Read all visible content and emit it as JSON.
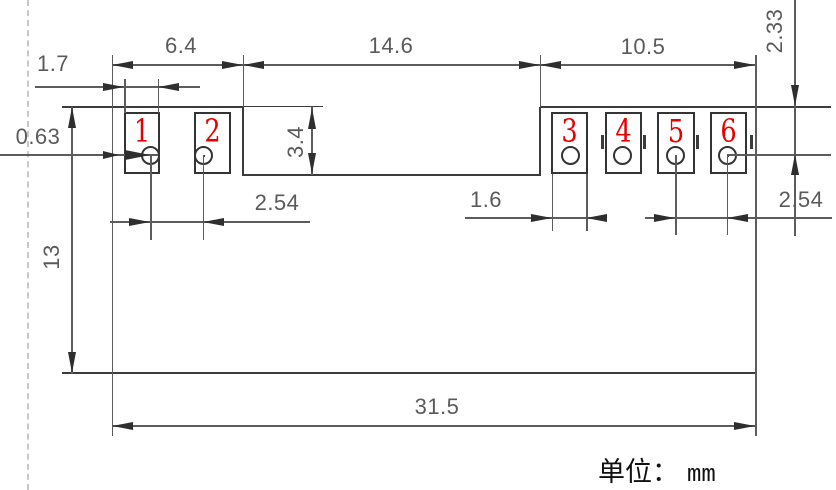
{
  "drawing": {
    "title": "component footprint dimension drawing",
    "unit": {
      "label": "单位：",
      "value": "mm"
    },
    "dims": {
      "left_block_width": "6.4",
      "middle_notch_width": "14.6",
      "right_block_width": "10.5",
      "pad1_width": "1.7",
      "edge_to_pad_offset": "0.63",
      "notch_depth": "3.4",
      "left_pin_pitch": "2.54",
      "pad3_width": "1.6",
      "right_pin_pitch": "2.54",
      "top_to_pin_center": "2.33",
      "body_height": "13",
      "total_width": "31.5"
    },
    "pads": [
      {
        "number": "1"
      },
      {
        "number": "2"
      },
      {
        "number": "3"
      },
      {
        "number": "4"
      },
      {
        "number": "5"
      },
      {
        "number": "6"
      }
    ],
    "colors": {
      "outline": "#3c3c3c",
      "dimension_text": "#5a5a5a",
      "pad_number": "#e60000",
      "dashed_guide": "#c8c8c8",
      "background": "#ffffff"
    }
  }
}
